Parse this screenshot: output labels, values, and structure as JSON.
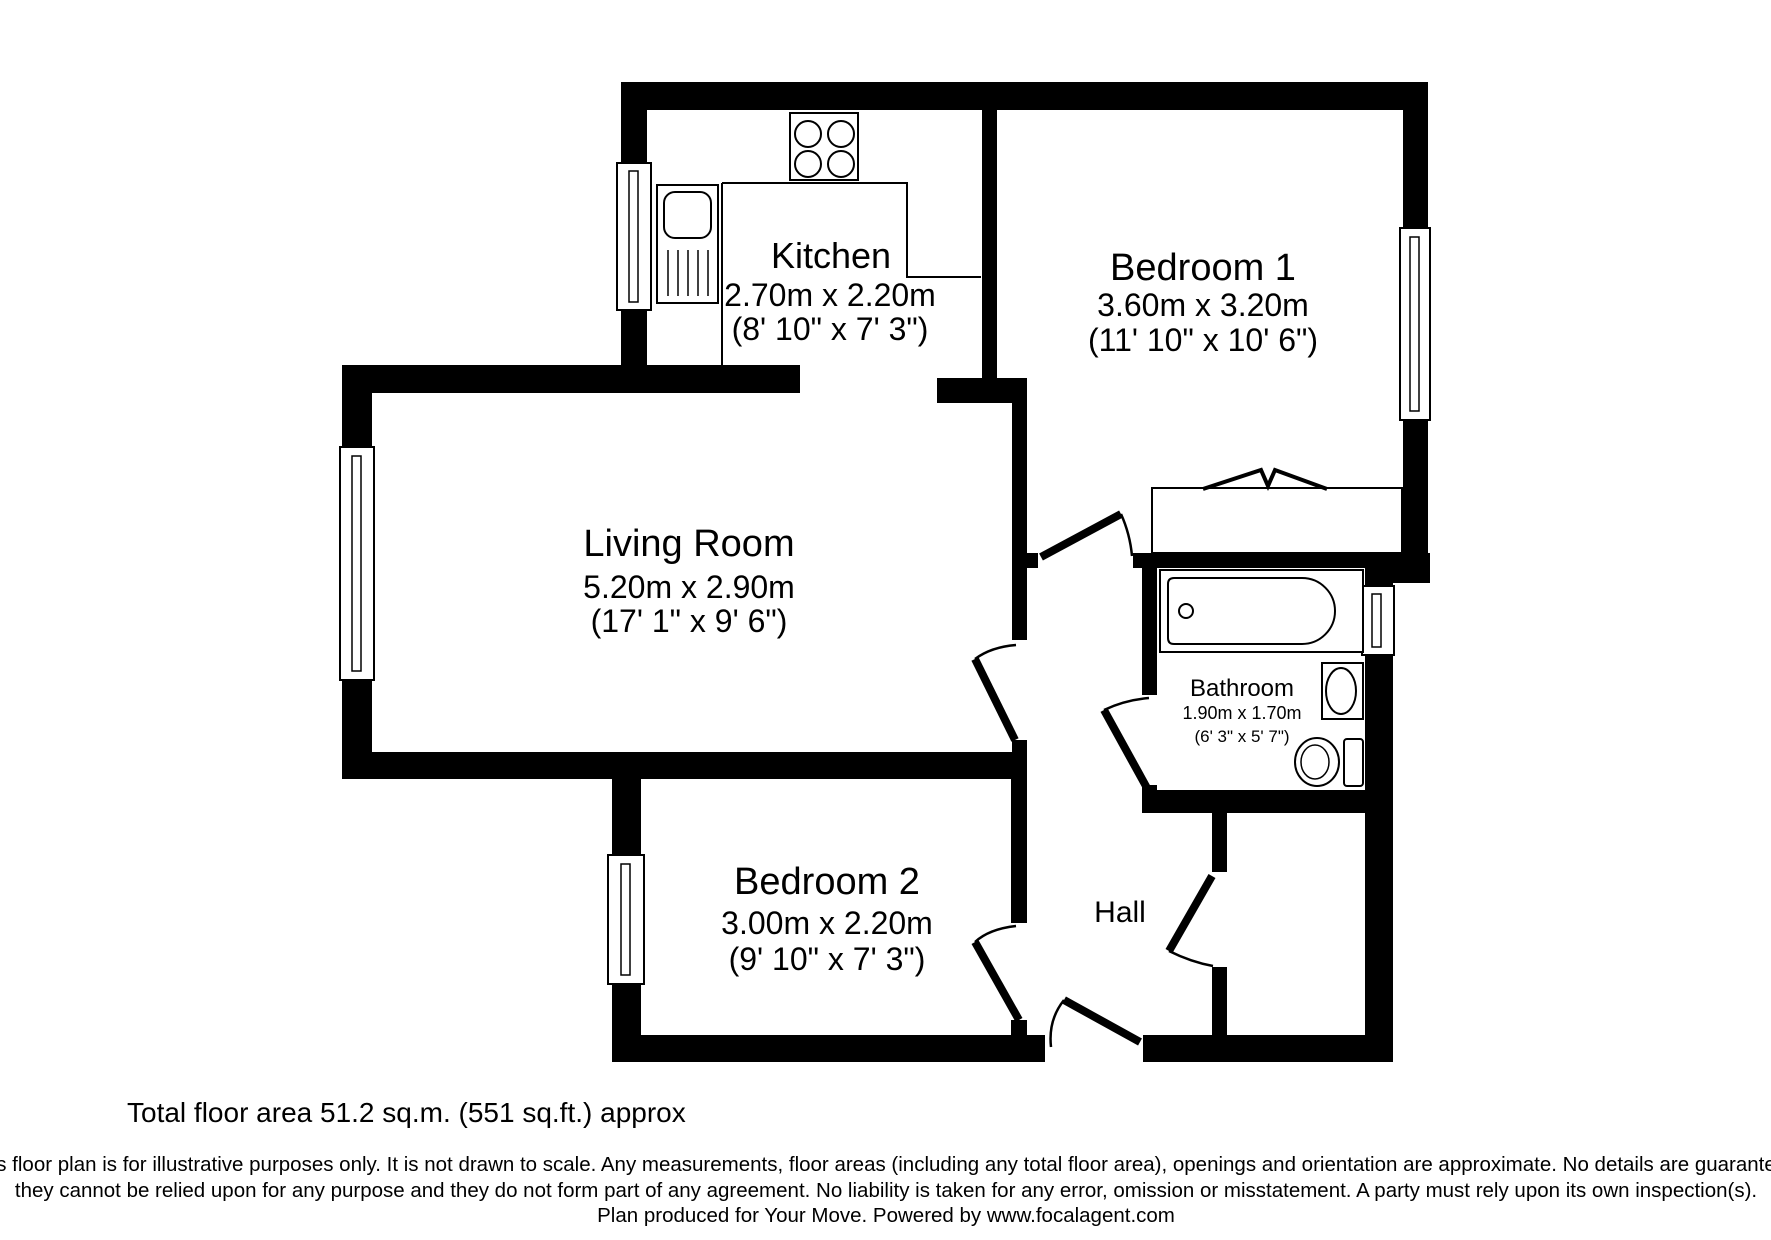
{
  "rooms": {
    "kitchen": {
      "name": "Kitchen",
      "metric": "2.70m x 2.20m",
      "imperial": "(8' 10\" x 7' 3\")"
    },
    "bedroom1": {
      "name": "Bedroom 1",
      "metric": "3.60m x 3.20m",
      "imperial": "(11' 10\" x 10' 6\")"
    },
    "living_room": {
      "name": "Living Room",
      "metric": "5.20m x 2.90m",
      "imperial": "(17' 1\" x 9' 6\")"
    },
    "bathroom": {
      "name": "Bathroom",
      "metric": "1.90m x 1.70m",
      "imperial": "(6' 3\" x 5' 7\")"
    },
    "bedroom2": {
      "name": "Bedroom 2",
      "metric": "3.00m x 2.20m",
      "imperial": "(9' 10\" x 7' 3\")"
    },
    "hall": {
      "name": "Hall"
    }
  },
  "footer": {
    "total_area": "Total floor area 51.2 sq.m. (551 sq.ft.) approx",
    "disclaimer_line1": "This floor plan is for illustrative purposes only. It is not drawn to scale. Any measurements, floor areas (including any total floor area), openings and orientation are approximate. No details are guaranteed,",
    "disclaimer_line2": "they cannot be relied upon for any purpose and they do not form part of any agreement. No liability is taken for any error, omission or misstatement. A party must rely upon its own inspection(s).",
    "disclaimer_line3": "Plan produced for Your Move. Powered by www.focalagent.com"
  },
  "colors": {
    "wall": "#000000",
    "background": "#ffffff"
  }
}
